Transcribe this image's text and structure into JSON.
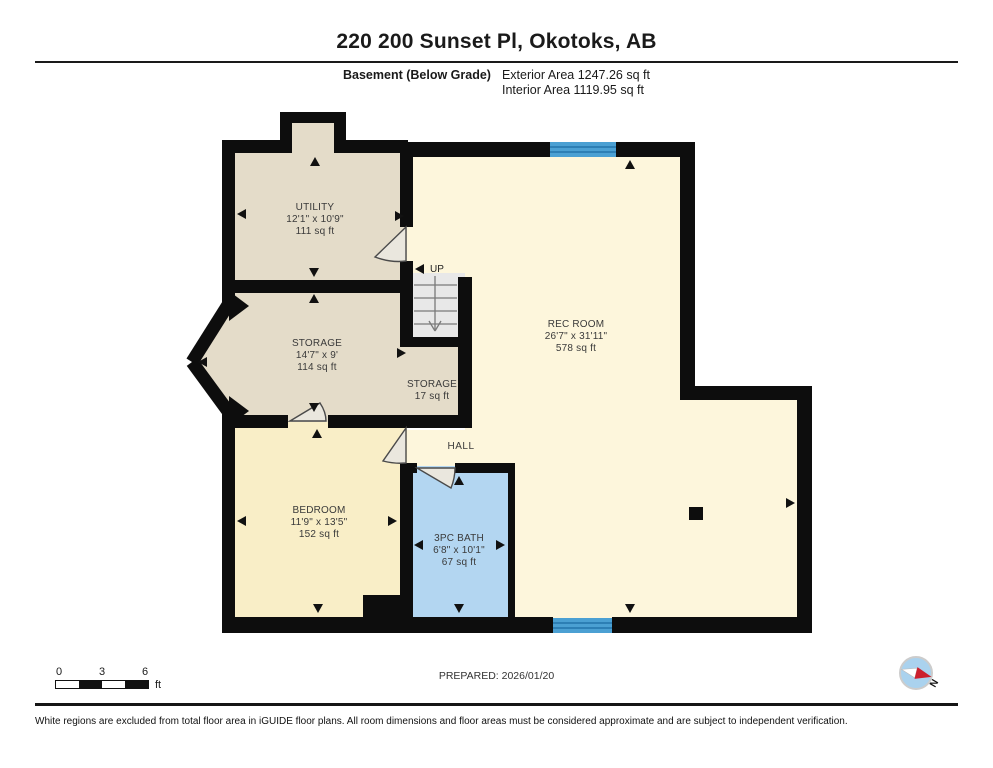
{
  "header": {
    "title": "220 200 Sunset Pl, Okotoks, AB",
    "floor_label": "Basement (Below Grade)",
    "exterior_area": "Exterior Area 1247.26 sq ft",
    "interior_area": "Interior Area 1119.95 sq ft"
  },
  "rooms": [
    {
      "name": "UTILITY",
      "dims": "12'1\" x 10'9\"",
      "area": "111 sq ft"
    },
    {
      "name": "STORAGE",
      "dims": "14'7\" x 9'",
      "area": "114 sq ft"
    },
    {
      "name": "STORAGE",
      "area": "17 sq ft"
    },
    {
      "name": "REC ROOM",
      "dims": "26'7\" x 31'11\"",
      "area": "578 sq ft"
    },
    {
      "name": "BEDROOM",
      "dims": "11'9\" x 13'5\"",
      "area": "152 sq ft"
    },
    {
      "name": "3PC BATH",
      "dims": "6'8\" x 10'1\"",
      "area": "67 sq ft"
    },
    {
      "name": "HALL"
    }
  ],
  "stairs": {
    "label": "UP"
  },
  "scale_bar": {
    "ticks": [
      "0",
      "3",
      "6"
    ],
    "unit": "ft"
  },
  "prepared": "PREPARED: 2026/01/20",
  "compass": {
    "label": "N"
  },
  "footer": "White regions are excluded from total floor area in iGUIDE floor plans. All room dimensions and floor areas must be considered approximate and are subject to independent verification.",
  "colors": {
    "wall": "#0d0d0d",
    "utility_storage": "#e4dcc9",
    "rec_hall": "#fdf6dc",
    "bedroom": "#f9eec7",
    "bath": "#b3d6f1",
    "window": "#4ba0d3",
    "stairs": "#e8e8e8"
  }
}
